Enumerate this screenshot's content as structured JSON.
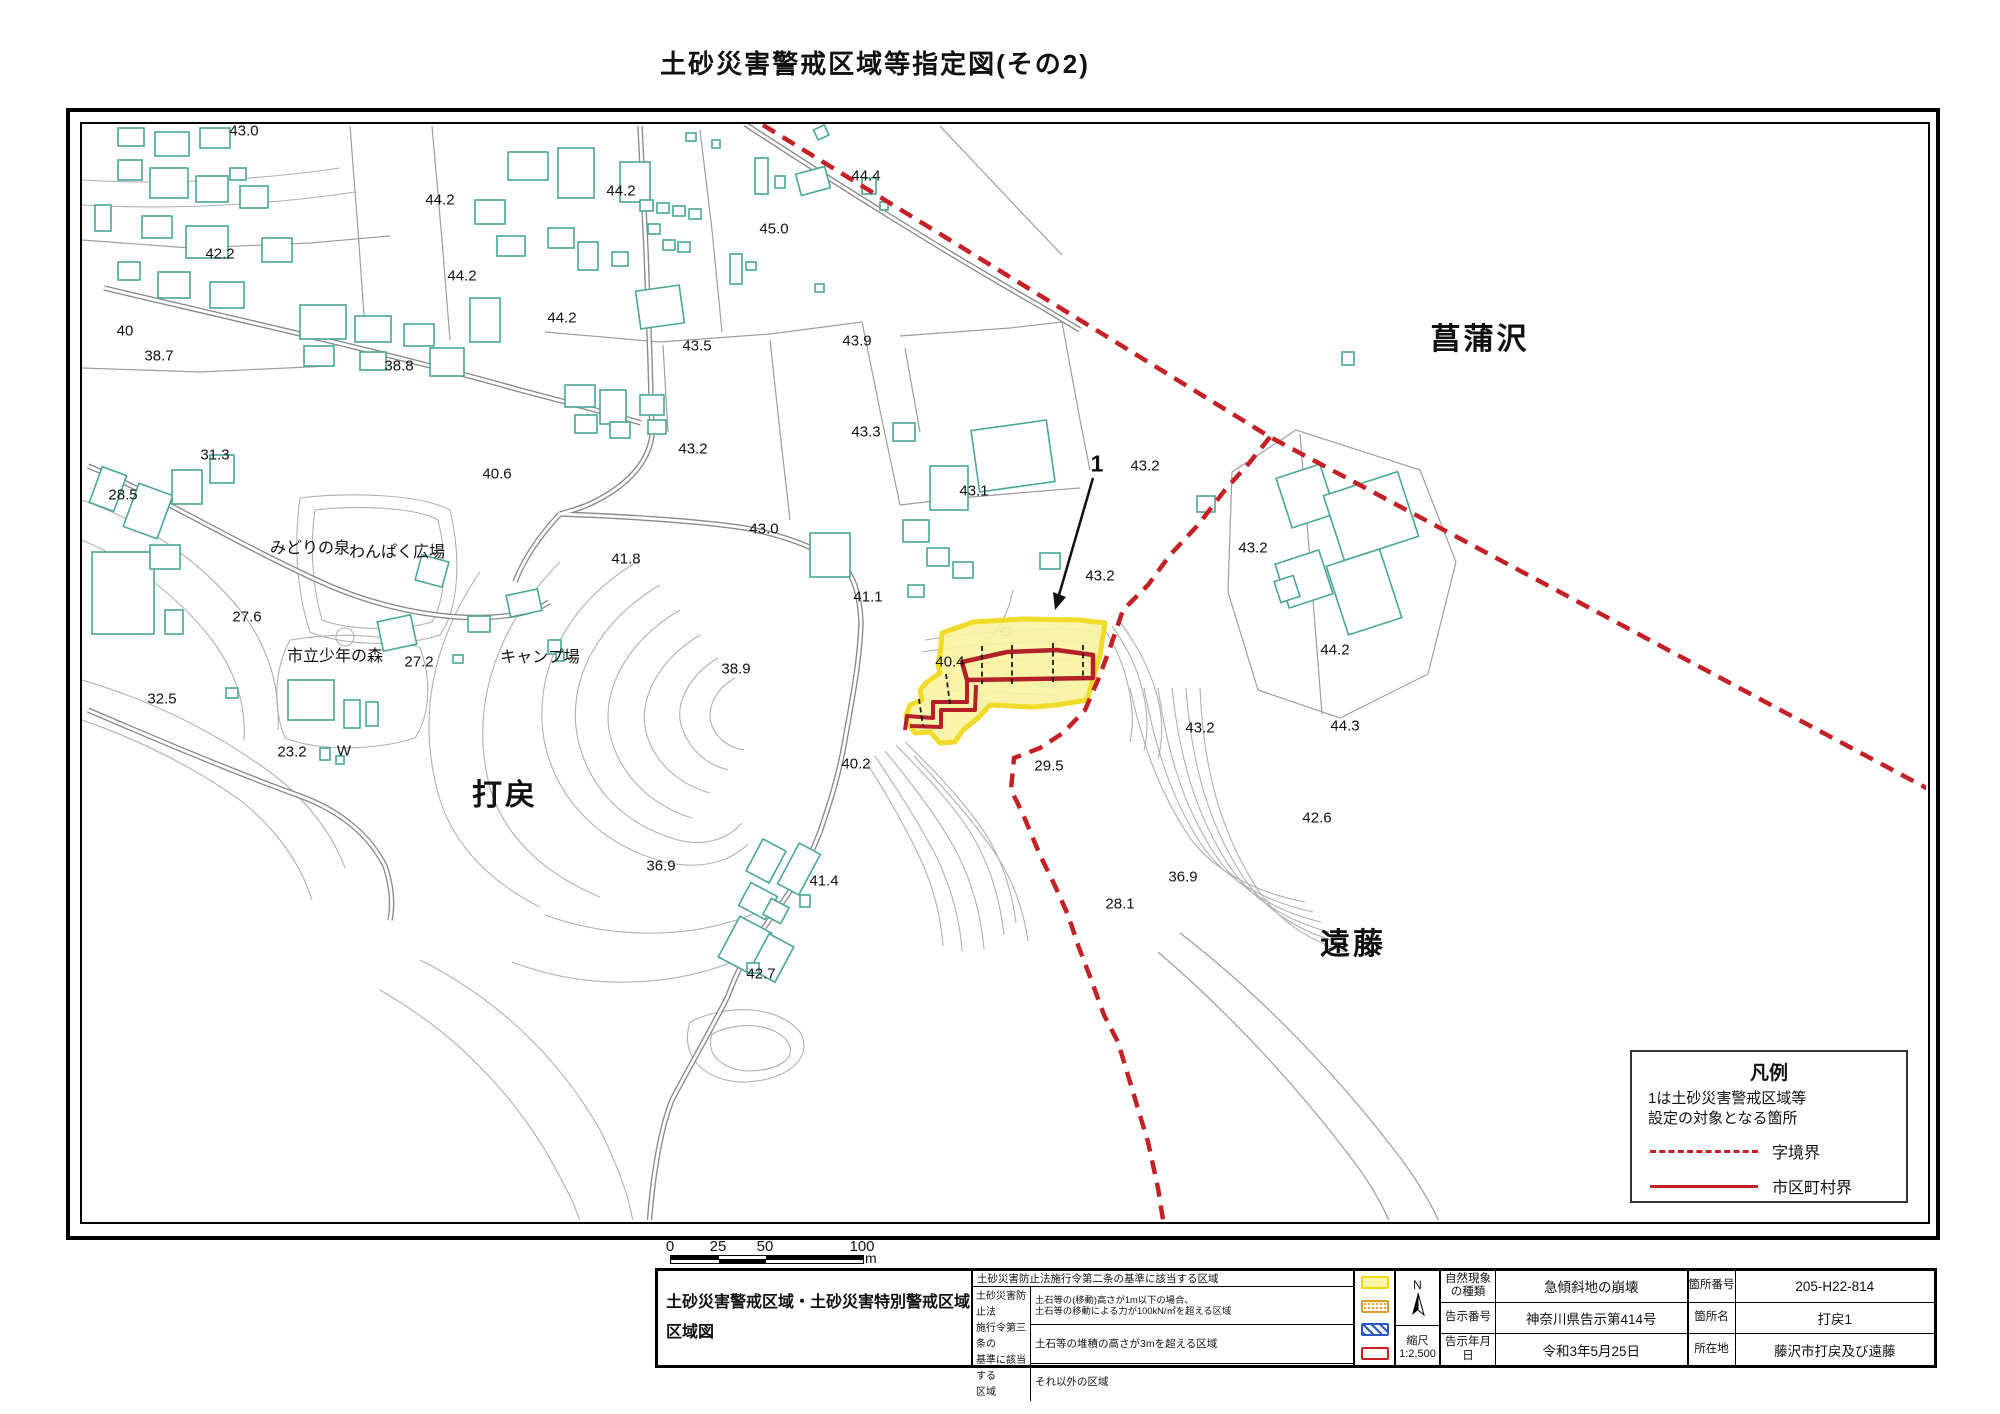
{
  "title": "土砂災害警戒区域等指定図(その2)",
  "colors": {
    "boundary_red": "#c42126",
    "special_zone_red": "#b3202a",
    "zone_yellow_fill": "#f8f3a0",
    "zone_yellow_border": "#f0dc28",
    "building_teal": "#4aa796",
    "contour_gray": "#b0b0b0"
  },
  "map": {
    "labels": [
      {
        "text": "43.0",
        "x": 244,
        "y": 131
      },
      {
        "text": "44.2",
        "x": 440,
        "y": 200
      },
      {
        "text": "42.2",
        "x": 220,
        "y": 254
      },
      {
        "text": "44.2",
        "x": 462,
        "y": 276
      },
      {
        "text": "44.2",
        "x": 621,
        "y": 191
      },
      {
        "text": "45.0",
        "x": 774,
        "y": 229
      },
      {
        "text": "44.4",
        "x": 866,
        "y": 176
      },
      {
        "text": "44.2",
        "x": 562,
        "y": 318
      },
      {
        "text": "43.5",
        "x": 697,
        "y": 346
      },
      {
        "text": "43.9",
        "x": 857,
        "y": 341
      },
      {
        "text": "40",
        "x": 125,
        "y": 331
      },
      {
        "text": "38.7",
        "x": 159,
        "y": 356
      },
      {
        "text": "38.8",
        "x": 399,
        "y": 366
      },
      {
        "text": "43.2",
        "x": 693,
        "y": 449
      },
      {
        "text": "43.3",
        "x": 866,
        "y": 432
      },
      {
        "text": "31.3",
        "x": 215,
        "y": 455
      },
      {
        "text": "28.5",
        "x": 123,
        "y": 495
      },
      {
        "text": "43.1",
        "x": 974,
        "y": 491
      },
      {
        "text": "43.0",
        "x": 764,
        "y": 529
      },
      {
        "text": "40.6",
        "x": 497,
        "y": 474
      },
      {
        "text": "41.8",
        "x": 626,
        "y": 559
      },
      {
        "text": "41.1",
        "x": 868,
        "y": 597
      },
      {
        "text": "43.2",
        "x": 1145,
        "y": 466
      },
      {
        "text": "43.2",
        "x": 1100,
        "y": 576
      },
      {
        "text": "43.2",
        "x": 1253,
        "y": 548
      },
      {
        "text": "27.6",
        "x": 247,
        "y": 617
      },
      {
        "text": "27.2",
        "x": 419,
        "y": 662
      },
      {
        "text": "44.2",
        "x": 1335,
        "y": 650
      },
      {
        "text": "32.5",
        "x": 162,
        "y": 699
      },
      {
        "text": "38.9",
        "x": 736,
        "y": 669
      },
      {
        "text": "40.4",
        "x": 950,
        "y": 662
      },
      {
        "text": "23.2",
        "x": 292,
        "y": 752
      },
      {
        "text": "W",
        "x": 344,
        "y": 751
      },
      {
        "text": "40.2",
        "x": 856,
        "y": 764
      },
      {
        "text": "43.2",
        "x": 1200,
        "y": 728
      },
      {
        "text": "44.3",
        "x": 1345,
        "y": 726
      },
      {
        "text": "29.5",
        "x": 1049,
        "y": 766
      },
      {
        "text": "42.6",
        "x": 1317,
        "y": 818
      },
      {
        "text": "36.9",
        "x": 661,
        "y": 866
      },
      {
        "text": "36.9",
        "x": 1183,
        "y": 877
      },
      {
        "text": "28.1",
        "x": 1120,
        "y": 904
      },
      {
        "text": "41.4",
        "x": 824,
        "y": 881
      },
      {
        "text": "42.7",
        "x": 761,
        "y": 974
      },
      {
        "text": "みどりの泉",
        "x": 310,
        "y": 549,
        "cls": "place"
      },
      {
        "text": "わんぱく広場",
        "x": 397,
        "y": 553,
        "cls": "place"
      },
      {
        "text": "市立少年の森",
        "x": 335,
        "y": 657,
        "cls": "place"
      },
      {
        "text": "キャンプ場",
        "x": 540,
        "y": 658,
        "cls": "place"
      },
      {
        "text": "打戻",
        "x": 505,
        "y": 796,
        "cls": "place-lg"
      },
      {
        "text": "菖蒲沢",
        "x": 1480,
        "y": 340,
        "cls": "place-lg"
      },
      {
        "text": "遠藤",
        "x": 1353,
        "y": 945,
        "cls": "place-lg"
      },
      {
        "text": "1",
        "x": 1097,
        "y": 464,
        "cls": "num-lg"
      }
    ]
  },
  "scale_bar": {
    "ticks": [
      "0",
      "25",
      "50",
      "100"
    ],
    "unit": "m"
  },
  "legend": {
    "title": "凡例",
    "note_line1": "1は土砂災害警戒区域等",
    "note_line2": "設定の対象となる箇所",
    "items": [
      {
        "label": "字境界"
      },
      {
        "label": "市区町村界"
      }
    ]
  },
  "info_table": {
    "map_title_line1": "土砂災害警戒区域・土砂災害特別警戒区域",
    "map_title_line2": "区域図",
    "zone_rows": {
      "row1": "土砂災害防止法施行令第二条の基準に該当する区域",
      "article3_l1": "土砂災害防止法",
      "article3_l2": "施行令第三条の",
      "article3_l3": "基準に該当する",
      "article3_l4": "区域",
      "row2_line1": "土石等の(移動)高さが1m以下の場合、",
      "row2_line2": "土石等の移動による力が100kN/㎡を超える区域",
      "row3": "土石等の堆積の高さが3mを超える区域",
      "row4": "それ以外の区域"
    },
    "compass": {
      "n": "N",
      "scale_label": "縮尺",
      "scale_value": "1:2,500"
    },
    "notice": [
      {
        "label": "自然現象の種類",
        "value": "急傾斜地の崩壊"
      },
      {
        "label": "告示番号",
        "value": "神奈川県告示第414号"
      },
      {
        "label": "告示年月日",
        "value": "令和3年5月25日"
      }
    ],
    "location": [
      {
        "label": "箇所番号",
        "value": "205-H22-814"
      },
      {
        "label": "箇所名",
        "value": "打戻1"
      },
      {
        "label": "所在地",
        "value": "藤沢市打戻及び遠藤"
      }
    ]
  }
}
